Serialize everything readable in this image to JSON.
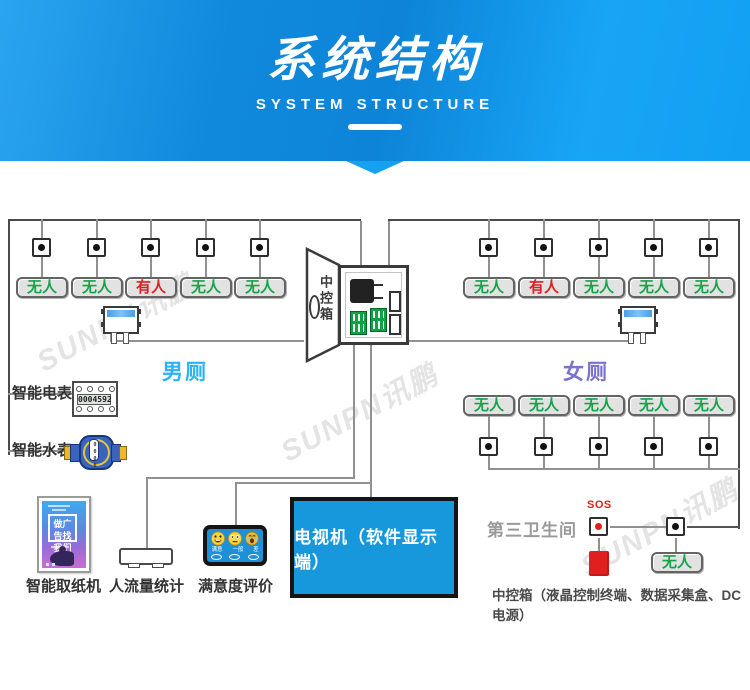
{
  "header": {
    "title": "系统结构",
    "subtitle": "SYSTEM STRUCTURE"
  },
  "watermark": "SUNPN讯鹏",
  "status": {
    "vacant": "无人",
    "occupied": "有人"
  },
  "rooms": {
    "men": {
      "name": "男厕",
      "stalls": [
        "无人",
        "无人",
        "有人",
        "无人",
        "无人"
      ]
    },
    "women": {
      "name": "女厕",
      "stalls_top": [
        "无人",
        "有人",
        "无人",
        "无人",
        "无人"
      ],
      "stalls_bottom": [
        "无人",
        "无人",
        "无人",
        "无人",
        "无人"
      ]
    }
  },
  "control_box": {
    "label": "中控箱"
  },
  "meters": {
    "electric": {
      "label": "智能电表",
      "reading": "0004592"
    },
    "water": {
      "label": "智能水表",
      "reading": "0000"
    }
  },
  "bottom_devices": {
    "paper_dispenser": {
      "label": "智能取纸机",
      "poster_text": "做广告找我们"
    },
    "people_counter": {
      "label": "人流量统计"
    },
    "satisfaction": {
      "label": "满意度评价",
      "options": [
        "满意",
        "一般",
        "差"
      ]
    },
    "tv": {
      "label": "电视机（软件显示端）"
    }
  },
  "third_restroom": {
    "title": "第三卫生间",
    "sos_label": "SOS",
    "vacant_label": "无人",
    "caption": "中控箱（液晶控制终端、数据采集盒、DC电源）"
  },
  "colors": {
    "header_blue": "#0d86da",
    "accent_blue": "#18a2f3",
    "tv_blue": "#1798dc",
    "vacant_green": "#17a449",
    "occupied_red": "#e0201f",
    "men_name_blue": "#2bb3f3",
    "women_name_purple": "#7a72cc"
  }
}
